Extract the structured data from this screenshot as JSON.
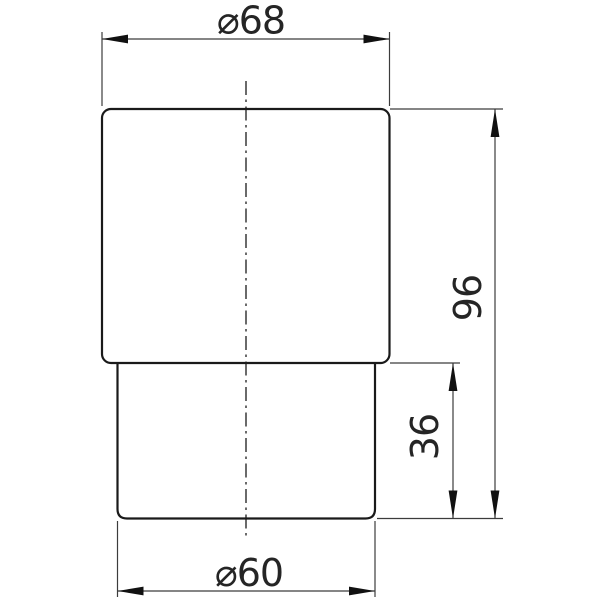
{
  "drawing": {
    "type": "technical-dimension-drawing",
    "part": "stepped cylindrical body, front elevation",
    "dimensions": {
      "top_diameter": {
        "label": "⌀68",
        "value": 68
      },
      "overall_height": {
        "label": "96",
        "value": 96
      },
      "lower_height": {
        "label": "36",
        "value": 36
      },
      "bottom_diameter": {
        "label": "⌀60",
        "value": 60
      }
    },
    "colors": {
      "background": "#ffffff",
      "outline": "#1a1a1a",
      "thin_line": "#3c3c3c",
      "arrow_fill": "#111111",
      "text": "#252525"
    }
  }
}
